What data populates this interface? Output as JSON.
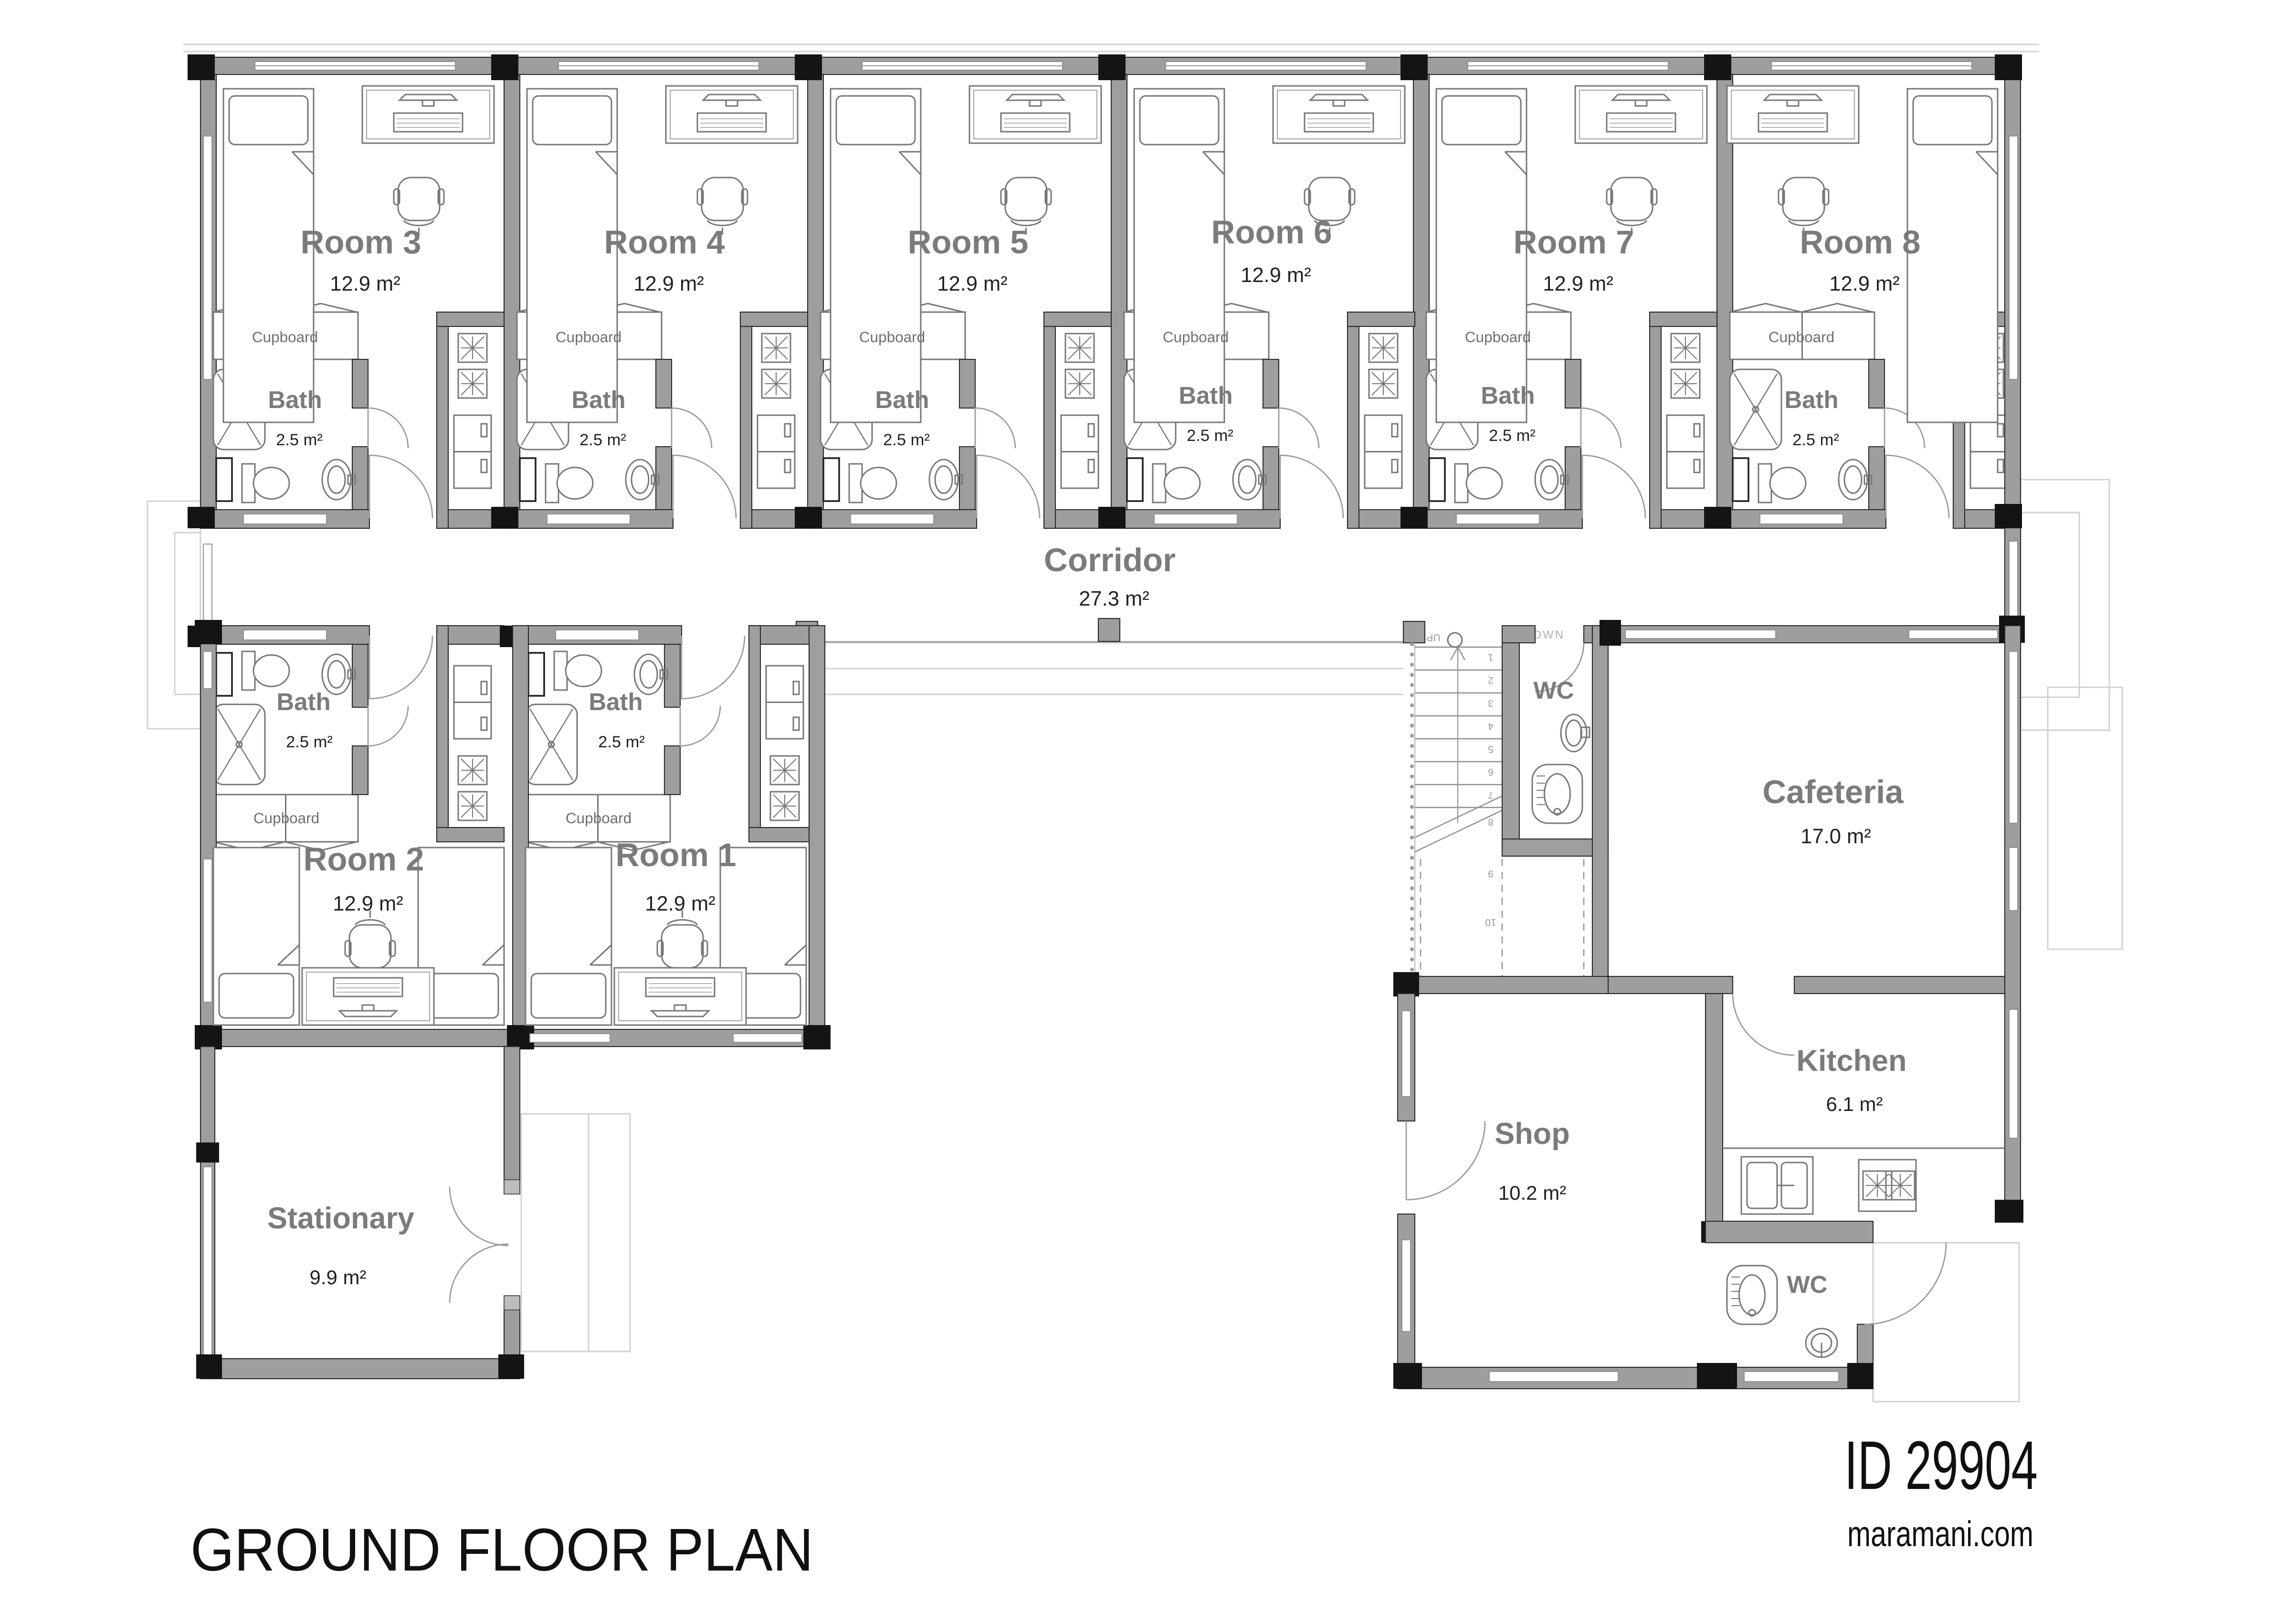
{
  "plan": {
    "title": "GROUND FLOOR PLAN",
    "id": "ID 29904",
    "website": "maramani.com"
  },
  "labels": {
    "cupboard": "Cupboard",
    "bath_name": "Bath",
    "bath_area": "2.5 m²",
    "room_area": "12.9 m²",
    "corridor_name": "Corridor",
    "corridor_area": "27.3 m²",
    "wc": "WC",
    "down": "DOWN",
    "up": "UP"
  },
  "top_rooms": [
    "Room 3",
    "Room 4",
    "Room 5",
    "Room 6",
    "Room 7",
    "Room 8"
  ],
  "bottom_rooms": [
    "Room 2",
    "Room 1"
  ],
  "stationary": {
    "name": "Stationary",
    "area": "9.9 m²"
  },
  "cafeteria": {
    "name": "Cafeteria",
    "area": "17.0 m²"
  },
  "kitchen": {
    "name": "Kitchen",
    "area": "6.1 m²"
  },
  "shop": {
    "name": "Shop",
    "area": "10.2 m²"
  },
  "stairs": {
    "steps": [
      "1",
      "2",
      "3",
      "4",
      "5",
      "6",
      "7",
      "8",
      "9",
      "10"
    ]
  },
  "colors": {
    "wall": "#9e9e9e",
    "wall_corner": "#141414",
    "room_label": "#7b7b7b",
    "area_text": "#222222",
    "faint_line": "#d2d2d2"
  }
}
